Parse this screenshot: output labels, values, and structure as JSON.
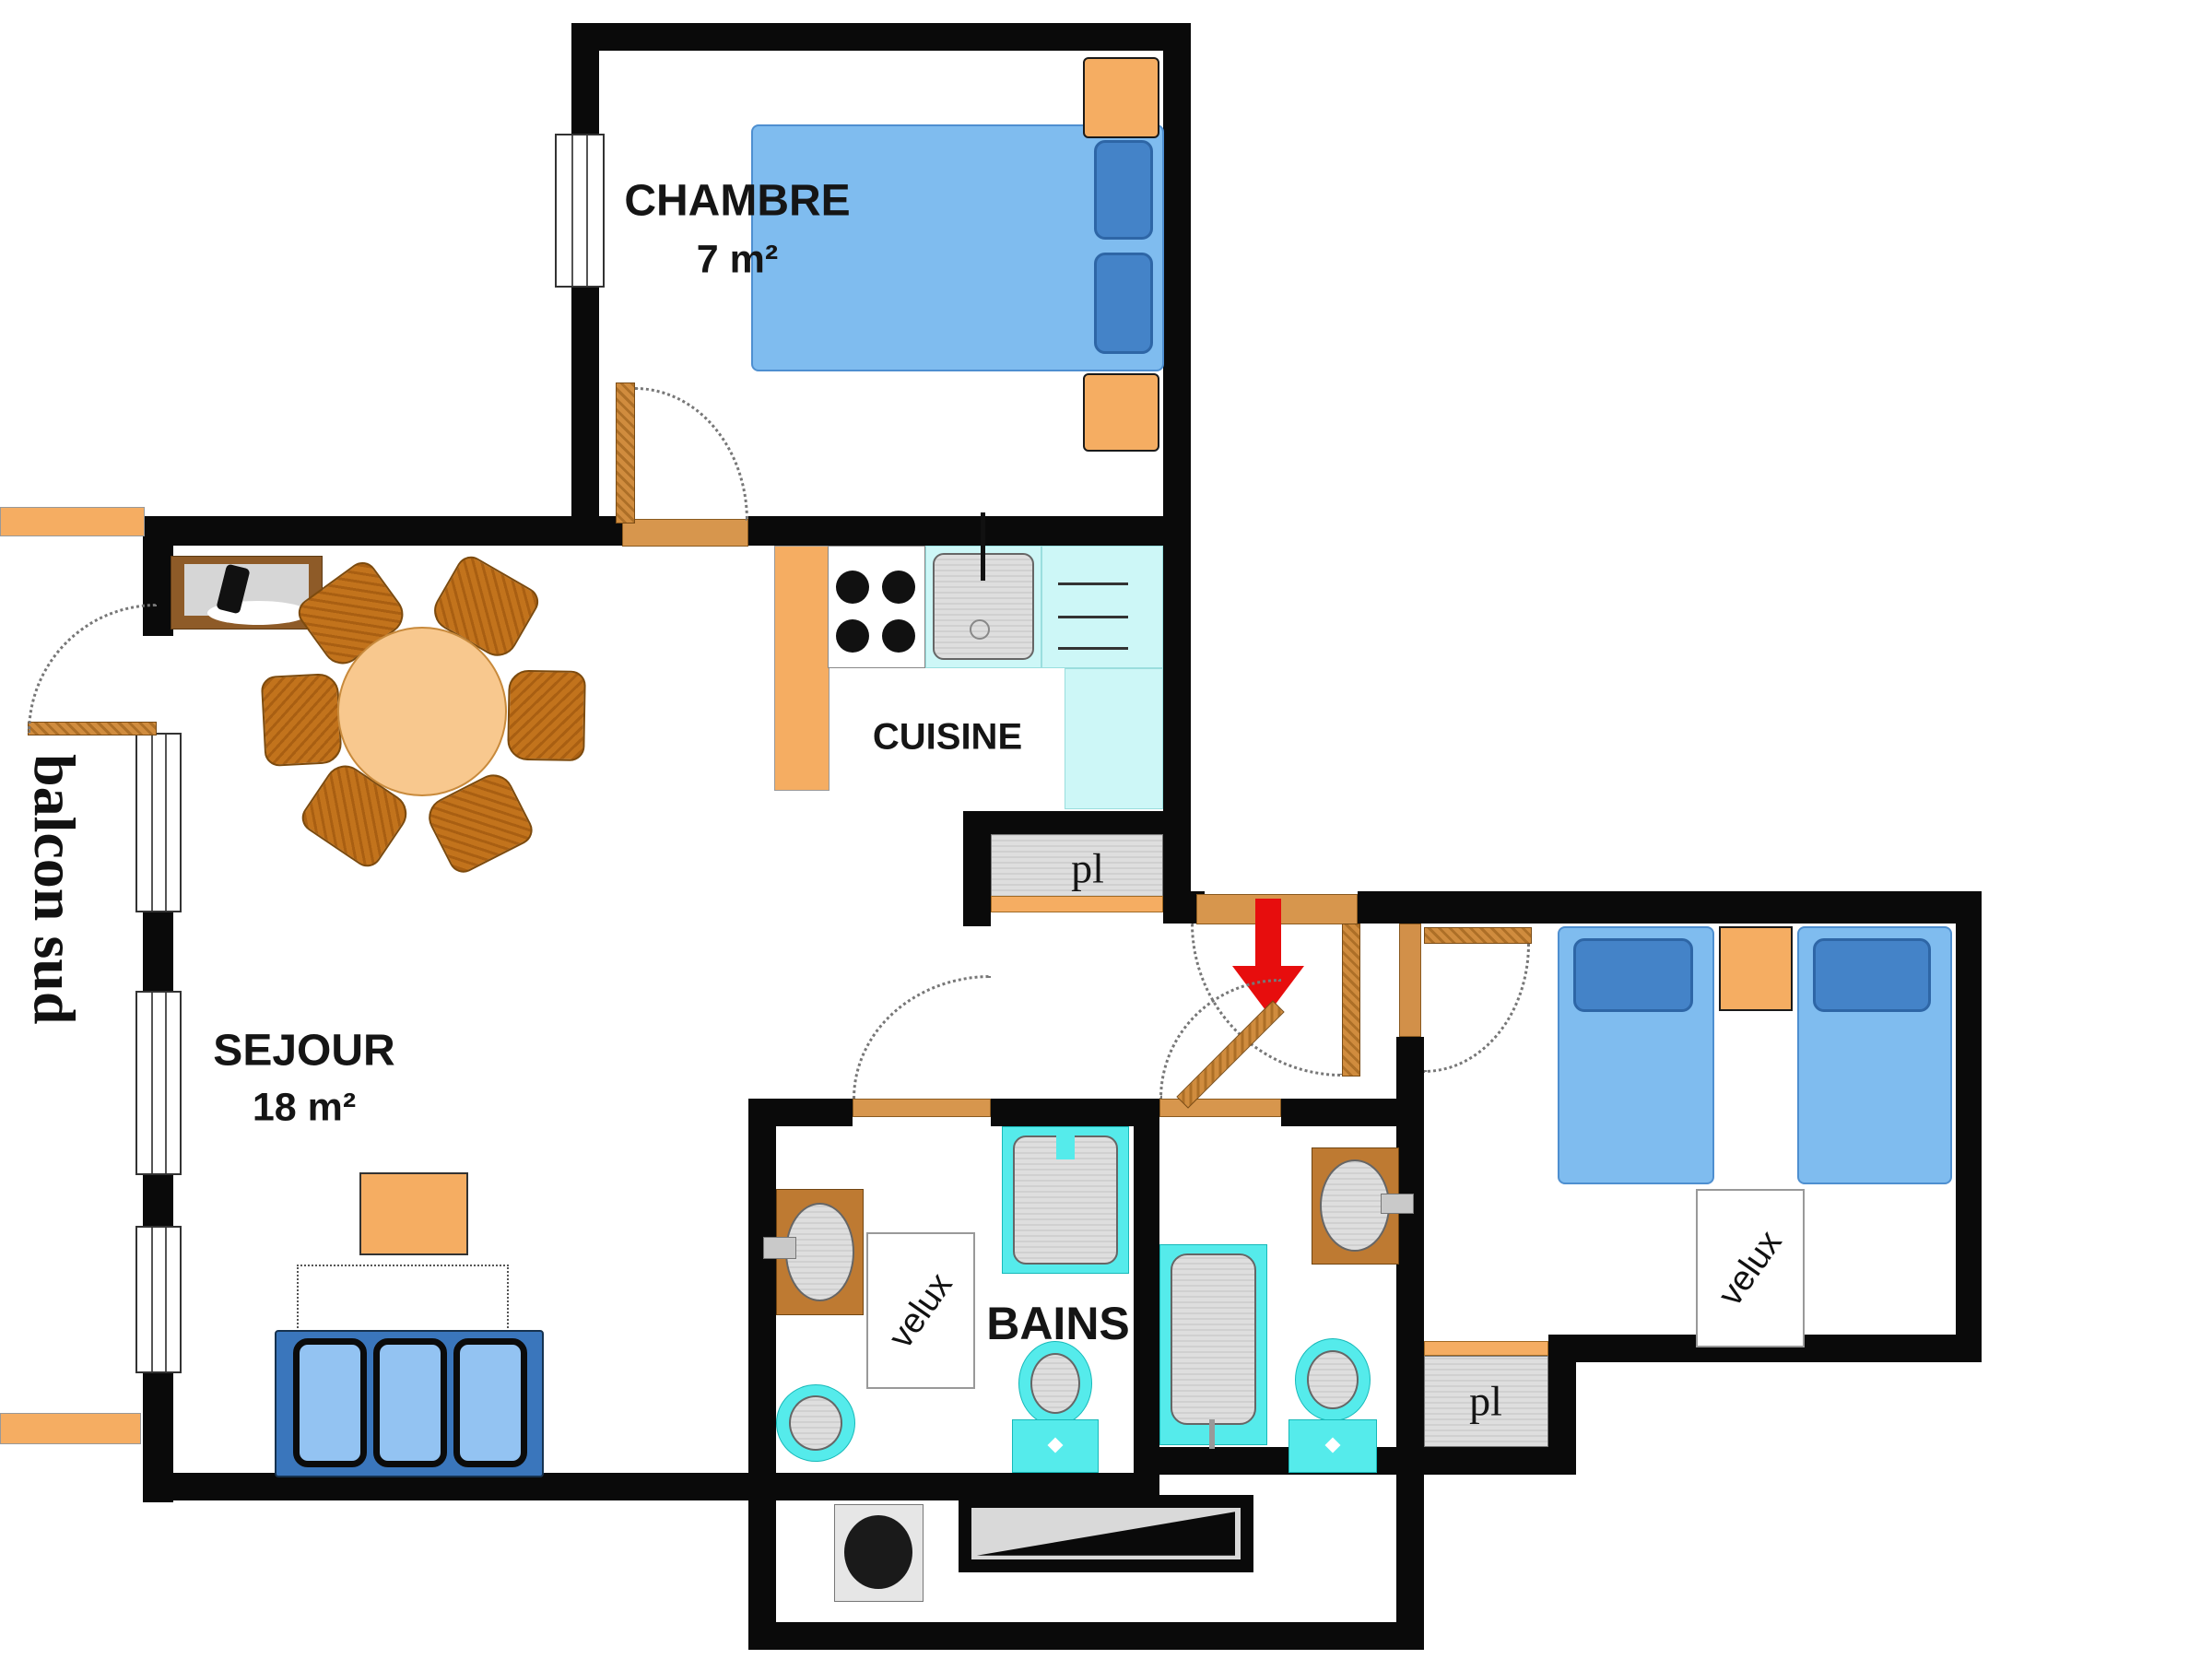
{
  "labels": {
    "chambre": {
      "name": "CHAMBRE",
      "area": "7 m²"
    },
    "sejour": {
      "name": "SEJOUR",
      "area": "18 m²"
    },
    "cuisine": {
      "name": "CUISINE"
    },
    "bains": {
      "name": "BAINS"
    },
    "balcon": {
      "name": "balcon sud"
    },
    "velux_bains": "velux",
    "velux_chambre2": "velux",
    "pl_entree": "pl",
    "pl_chambre2": "pl"
  },
  "colors": {
    "wall": "#0a0a0a",
    "furniture_orange": "#f5ad62",
    "wood_chair": "#c2731c",
    "door_tan": "#d08c3e",
    "bed_blue": "#7fbcef",
    "pillow_blue": "#4483c8",
    "fixture_cyan": "#55ebeb",
    "counter_cyan": "#cdf7f7",
    "counter_brown": "#be7a32",
    "sofa_blue": "#3a76bc",
    "cushion_blue": "#93c3f2",
    "entry_arrow_red": "#e70d0d",
    "fixture_gray": "#d8d8d8"
  }
}
